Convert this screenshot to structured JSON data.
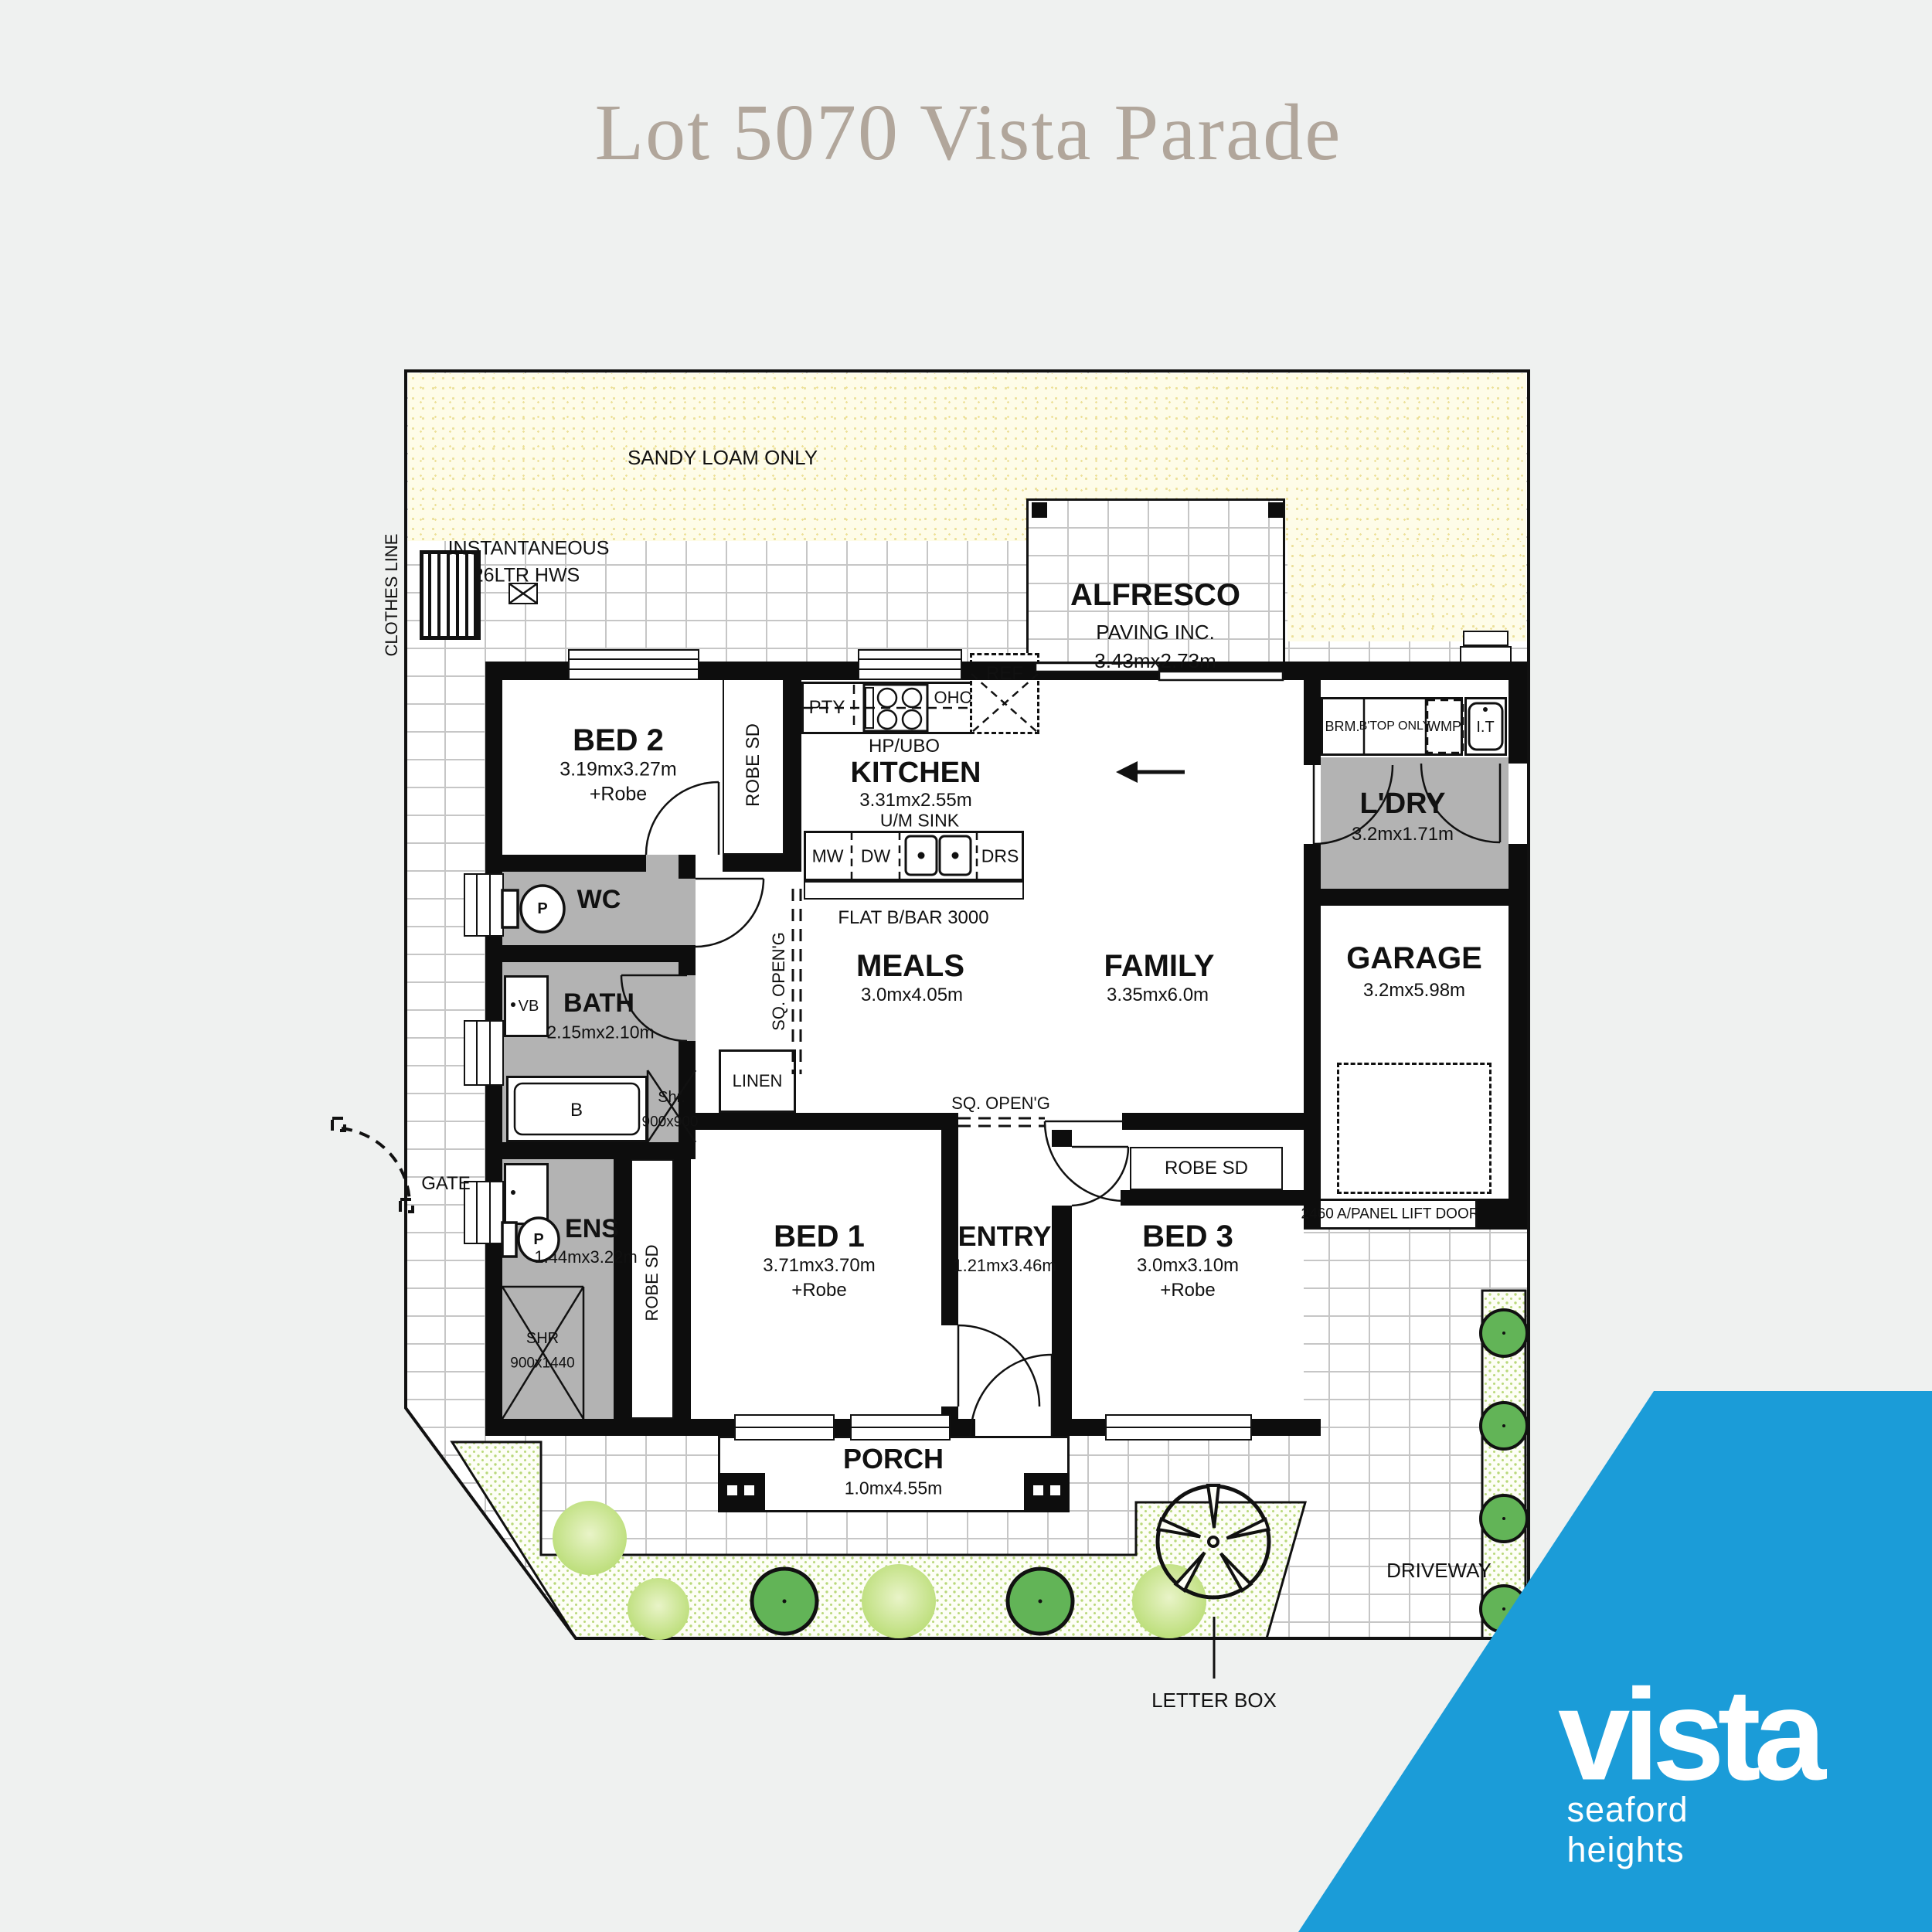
{
  "colors": {
    "bg": "#eff1f0",
    "blue": "#1b9cd8",
    "title": "#b1a69b",
    "wall": "#0d0d0d",
    "grayfill": "#b3b3b3",
    "sandy_bg": "#fefce8",
    "sandy_dot": "#ece09a",
    "garden_dot": "#b9d87a",
    "tree_dark": "#62b457",
    "tree_light": "#cde79b",
    "brick_line": "#c6c6c6"
  },
  "page": {
    "title": "Lot 5070 Vista Parade"
  },
  "logo": {
    "brand": "vista",
    "tagline": "seaford heights"
  },
  "annotations": {
    "sandy": "SANDY LOAM ONLY",
    "inst1": "INSTANTANEOUS",
    "inst2": "26LTR HWS",
    "clothes": "CLOTHES LINE",
    "gate": "GATE",
    "driveway": "DRIVEWAY",
    "letterbox": "LETTER BOX"
  },
  "rooms": {
    "alfresco": {
      "name": "ALFRESCO",
      "note": "PAVING INC.",
      "dims": "3.43mx2.73m"
    },
    "bed2": {
      "name": "BED 2",
      "dims": "3.19mx3.27m",
      "extra": "+Robe"
    },
    "kitchen": {
      "name": "KITCHEN",
      "dims": "3.31mx2.55m"
    },
    "ldry": {
      "name": "L'DRY",
      "dims": "3.2mx1.71m"
    },
    "wc": {
      "name": "WC"
    },
    "bath": {
      "name": "BATH",
      "dims": "2.15mx2.10m"
    },
    "meals": {
      "name": "MEALS",
      "dims": "3.0mx4.05m"
    },
    "family": {
      "name": "FAMILY",
      "dims": "3.35mx6.0m"
    },
    "garage": {
      "name": "GARAGE",
      "dims": "3.2mx5.98m",
      "door": "2460 A/PANEL LIFT DOOR"
    },
    "ens": {
      "name": "ENS",
      "dims": "1.44mx3.22m"
    },
    "bed1": {
      "name": "BED 1",
      "dims": "3.71mx3.70m",
      "extra": "+Robe"
    },
    "entry": {
      "name": "ENTRY",
      "dims": "1.21mx3.46m"
    },
    "bed3": {
      "name": "BED 3",
      "dims": "3.0mx3.10m",
      "extra": "+Robe"
    },
    "porch": {
      "name": "PORCH",
      "dims": "1.0mx4.55m"
    },
    "linen": {
      "name": "LINEN"
    }
  },
  "fixtures": {
    "pty": "PTY",
    "ohc": "OHC",
    "ref": "REF",
    "hpubo": "HP/UBO",
    "umsink": "U/M SINK",
    "mw": "MW",
    "dw": "DW",
    "drs": "DRS",
    "bbar": "FLAT B/BAR 3000",
    "brm": "BRM.",
    "btop": "B'TOP ONLY",
    "wmp": "WMP",
    "it": "I.T",
    "robesd": "ROBE SD",
    "sqopen": "SQ. OPEN'G",
    "vb": "VB",
    "p": "P",
    "b": "B",
    "shr_small": "Shr.",
    "shr_small_size": "900x900",
    "shr": "SHR",
    "shr_size": "900x1440"
  }
}
